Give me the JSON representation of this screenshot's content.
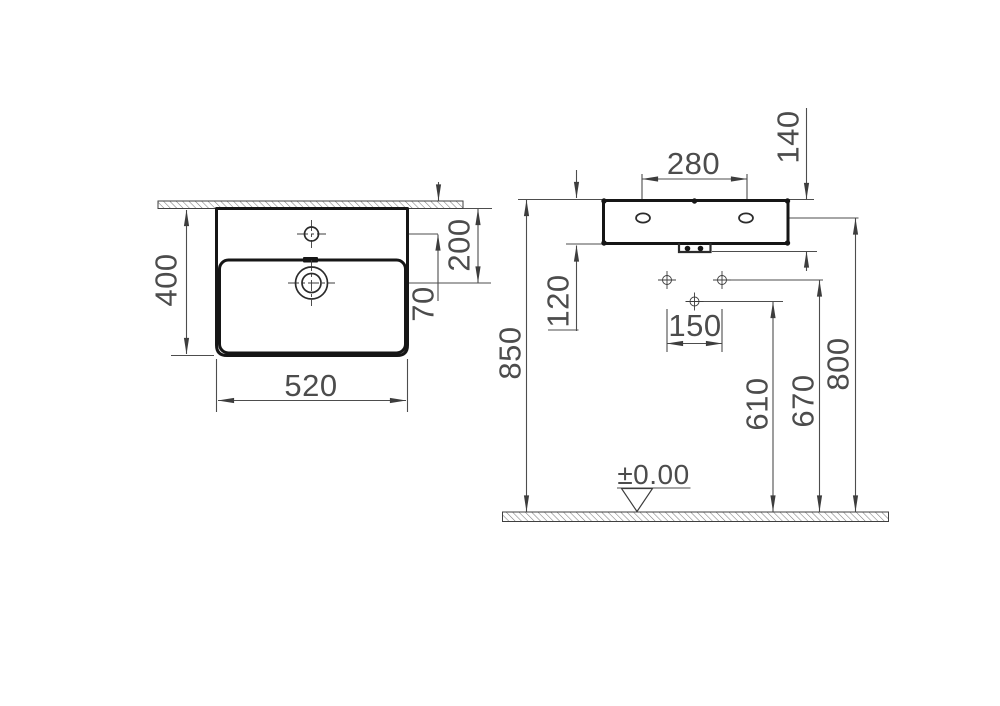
{
  "colors": {
    "outline": "#161616",
    "dimension_lines": "#4d4d4d",
    "text": "#4c4c4c"
  },
  "plan_view": {
    "basin_width": "520",
    "basin_depth": "400",
    "drain_center_from_wall": "200",
    "tap_hole_from_wall": "70"
  },
  "elevation_view": {
    "hanger_hole_spacing": "280",
    "rim_to_outlet_bottom": "140",
    "rim_to_underside": "120",
    "rim_height_from_floor": "850",
    "fixing_hole_spacing": "150",
    "lower_fixing_hole_height": "610",
    "fixing_hole_height": "670",
    "hanger_hole_height": "800",
    "floor_datum_label": "±0.00"
  }
}
